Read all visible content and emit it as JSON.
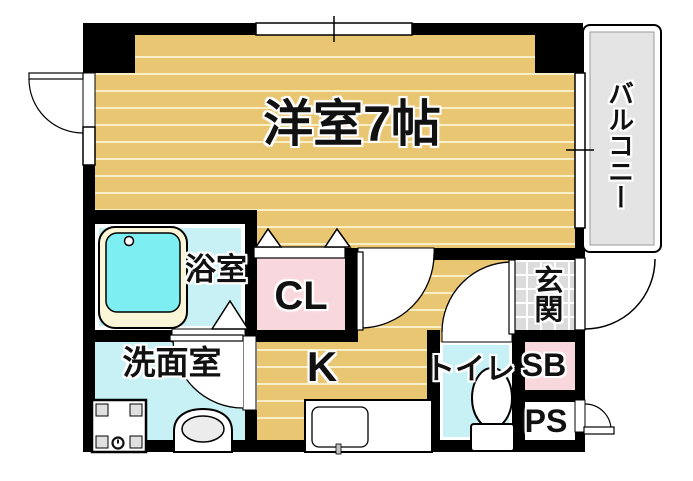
{
  "floorplan": {
    "title": "1K apartment floor plan",
    "rooms": {
      "western_room": {
        "label": "洋室7帖",
        "floor_color": "#e9c672"
      },
      "balcony": {
        "label": "バルコニー",
        "floor_color": "#e4e4e4"
      },
      "bathroom": {
        "label": "浴室",
        "floor_color": "#c7f1f5"
      },
      "closet": {
        "label": "CL",
        "floor_color": "#f9d8dd"
      },
      "washroom": {
        "label": "洗面室",
        "floor_color": "#c7f1f5"
      },
      "kitchen": {
        "label": "K",
        "floor_color": "#e9c672"
      },
      "toilet": {
        "label": "トイレ",
        "floor_color": "#c7f1f5"
      },
      "entrance": {
        "label": "玄関",
        "floor_color": "#dcdcdc"
      },
      "shoe_box": {
        "label": "SB",
        "floor_color": "#f9d8dd"
      },
      "pipe_space": {
        "label": "PS",
        "floor_color": "#ffffff"
      }
    },
    "colors": {
      "wall": "#000000",
      "floor_stripe": "#f8efc9",
      "label_halo": "#ffffff",
      "bathtub_rim": "#fcf6d8",
      "bathtub_water": "#7deef2"
    },
    "fixtures": [
      "bathtub",
      "washing-machine",
      "wash-basin",
      "kitchen-sink",
      "toilet-bowl"
    ]
  }
}
